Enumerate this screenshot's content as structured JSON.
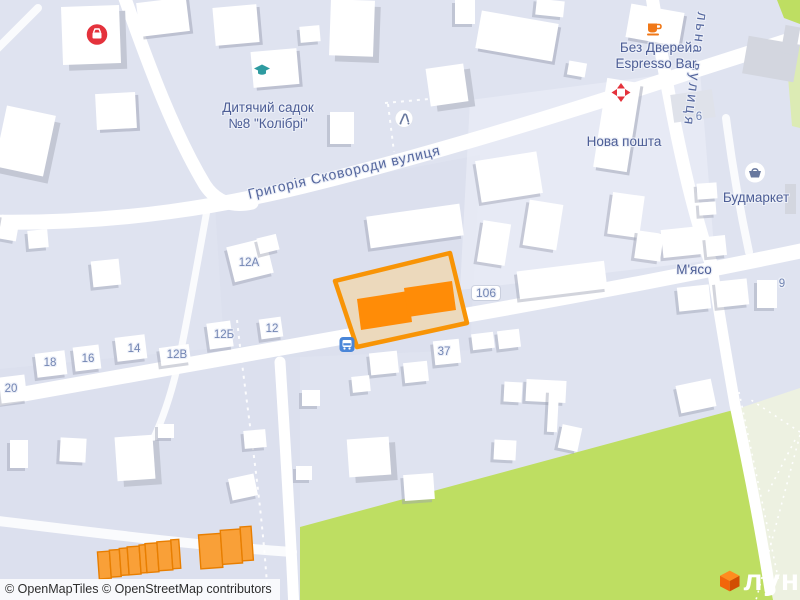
{
  "map": {
    "attribution": "© OpenMapTiles © OpenStreetMap contributors",
    "logo_text": "лун",
    "colors": {
      "base": "#dfe3f0",
      "block": "#d9deec",
      "road": "#ffffff",
      "bld": "#ffffff",
      "bld_gray": "#d3d6df",
      "shadow": "#c3c7d4",
      "accent": "#f89406",
      "plot_fill": "#ecd9bc",
      "bld_orange": "#ff8c07",
      "garage": "#f9a038",
      "garage_border": "#e87e00",
      "park": "#bede62",
      "pale_park": "#edf1e1",
      "pale_green": "#dcebb4",
      "label": "#4d5e96",
      "street_label": "#55679e",
      "num": "#7285b3",
      "bus": "#4a86d8",
      "red": "#e4323c",
      "teal": "#2e9ba0",
      "coffee": "#f07818",
      "slate": "#68789e",
      "logo_top": "#ff8d1f",
      "logo_left": "#f2660a",
      "logo_right": "#d14e03"
    }
  },
  "pois": {
    "kindergarten": {
      "line1": "Дитячий садок",
      "line2": "№8 \"Колібрі\""
    },
    "espresso": {
      "line1": "Без Дверей",
      "line2": "Espresso Bar"
    },
    "nova_poshta": {
      "label": "Нова пошта"
    },
    "budmarket": {
      "label": "Будмаркет"
    },
    "myaso": {
      "label": "М'ясо"
    }
  },
  "streets": {
    "skovorody": "Григорія Сковороди вулиця",
    "vertical": "льна вулиця"
  },
  "house_numbers": [
    {
      "label": "12А",
      "x": 249,
      "y": 263
    },
    {
      "label": "12Б",
      "x": 224,
      "y": 335
    },
    {
      "label": "12",
      "x": 272,
      "y": 329
    },
    {
      "label": "12В",
      "x": 177,
      "y": 355
    },
    {
      "label": "14",
      "x": 134,
      "y": 349
    },
    {
      "label": "16",
      "x": 88,
      "y": 359
    },
    {
      "label": "18",
      "x": 50,
      "y": 363
    },
    {
      "label": "20",
      "x": 11,
      "y": 389
    },
    {
      "label": "106",
      "x": 486,
      "y": 293,
      "pill": true
    },
    {
      "label": "37",
      "x": 444,
      "y": 352
    },
    {
      "label": "9",
      "x": 782,
      "y": 284
    },
    {
      "label": "6",
      "x": 699,
      "y": 117
    }
  ]
}
